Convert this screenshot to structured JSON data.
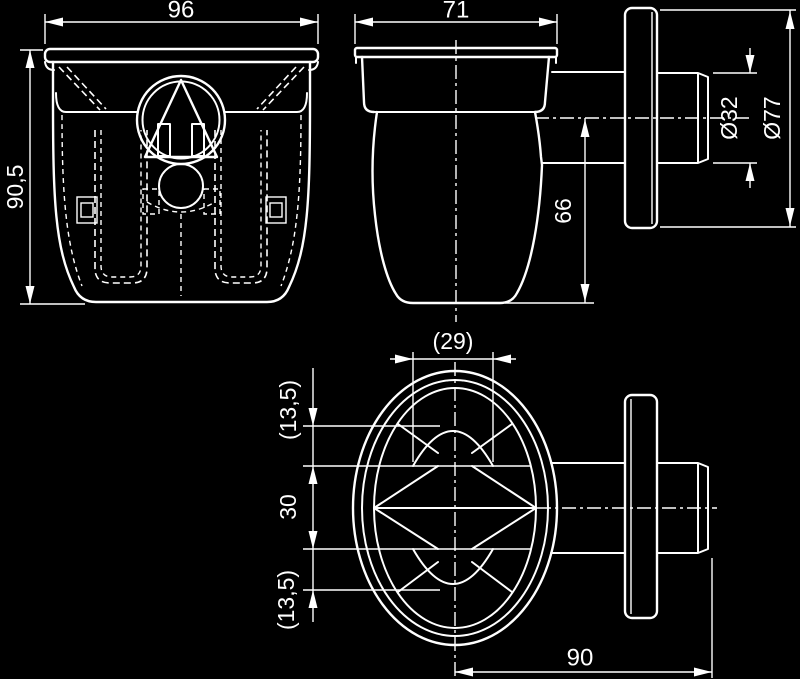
{
  "colors": {
    "background": "#000000",
    "line": "#ffffff",
    "text": "#ffffff"
  },
  "views": {
    "front": {
      "dim_width": "96",
      "dim_height": "90,5"
    },
    "side": {
      "dim_width": "71",
      "dim_height": "66"
    },
    "outlet": {
      "dim_pipe": "Ø32",
      "dim_flange": "Ø77"
    },
    "plan": {
      "dim_grate": "(29)",
      "dim_upper": "(13,5)",
      "dim_middle": "30",
      "dim_lower": "(13,5)",
      "dim_length": "90"
    }
  }
}
